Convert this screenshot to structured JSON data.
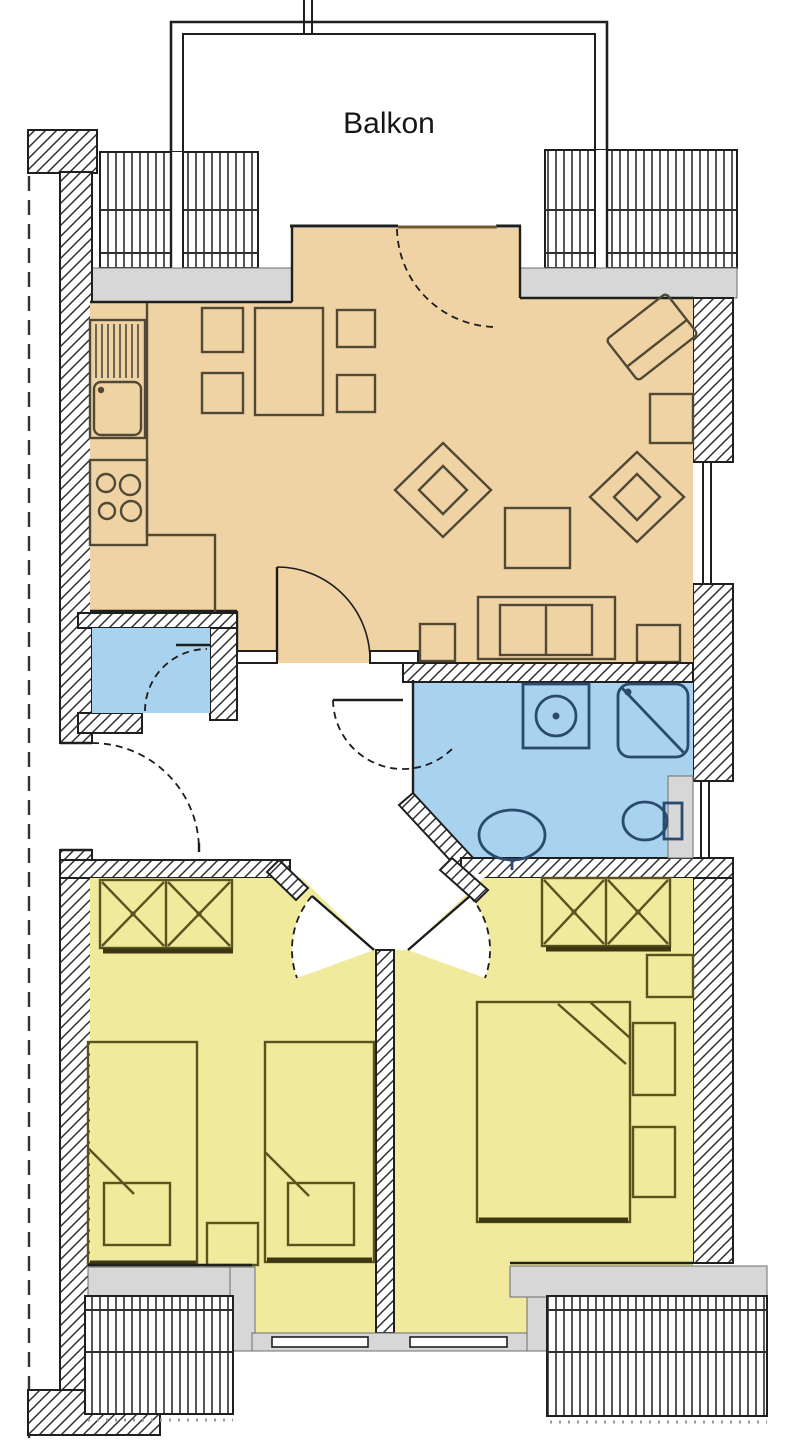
{
  "title": "Apartment floor plan",
  "labels": {
    "balcony": "Balkon"
  },
  "colors": {
    "living_kitchen": "#f0d3a5",
    "bedroom": "#efea9c",
    "bath": "#a9d2ef",
    "sill": "#d7d7d7",
    "wall_line": "#1f1f1f",
    "hatch_line": "#2e2e2e",
    "furniture": "#4f4936",
    "bedroom_furniture": "#5a531f",
    "furniture_shadow": "#3c3713",
    "fixture": "#2a4a6e",
    "door_arc": "#1c1c1c",
    "balcony_door": "#6f5a33"
  }
}
